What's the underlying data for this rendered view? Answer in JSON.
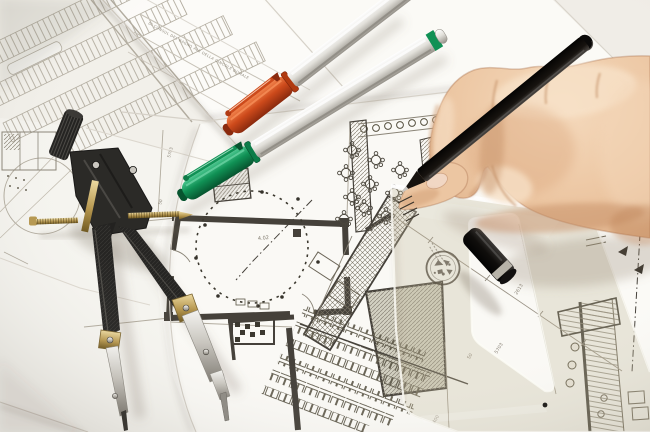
{
  "scene": {
    "type": "photograph",
    "subject": "Hand with black pen drawing on architectural floor plans, with drafting compass, orange and green markers, pen cap and transparent set-square",
    "objects": [
      "blueprint-sheets",
      "site-plan",
      "floor-plan",
      "drafting-compass",
      "orange-marker",
      "green-marker",
      "black-pen",
      "hand",
      "pen-cap",
      "set-square-ruler",
      "round-stamp"
    ]
  },
  "colors": {
    "paper_white": "#f8f7f3",
    "paper_bright": "#fcfbf8",
    "paper_dim": "#f2f0ea",
    "line_light": "#b2ac9f",
    "line_mid": "#8a8477",
    "wall_dark": "#45413a",
    "ink_dark": "#36332b",
    "skin_base": "#ecc6a2",
    "skin_light": "#f6ddc2",
    "skin_shadow": "#cf9a70",
    "pen_black": "#17130f",
    "cap_black": "#121010",
    "marker_orange": "#cd4a1b",
    "marker_orange_dark": "#8a2a0e",
    "marker_green": "#109155",
    "marker_green_dark": "#07542f",
    "marker_silver": "#dddbd5",
    "compass_body": "#2b2a27",
    "compass_brass": "#b6974f",
    "compass_steel": "#c9c6bf",
    "ruler_tint": "rgba(193,183,152,0.30)",
    "ruler_edge": "#fdfcf6",
    "stamp_ink": "#5f5749",
    "shadow_soft": "rgba(120,108,92,0.28)"
  },
  "labels": {
    "room_number": "4.02",
    "dim_a": "2613",
    "dim_b": "5703",
    "dim_c": "50",
    "dim_d": "400",
    "title_strip": "DI CONSUL DEL BAGNO ALB DELLA GINCOLE DOMALE"
  }
}
